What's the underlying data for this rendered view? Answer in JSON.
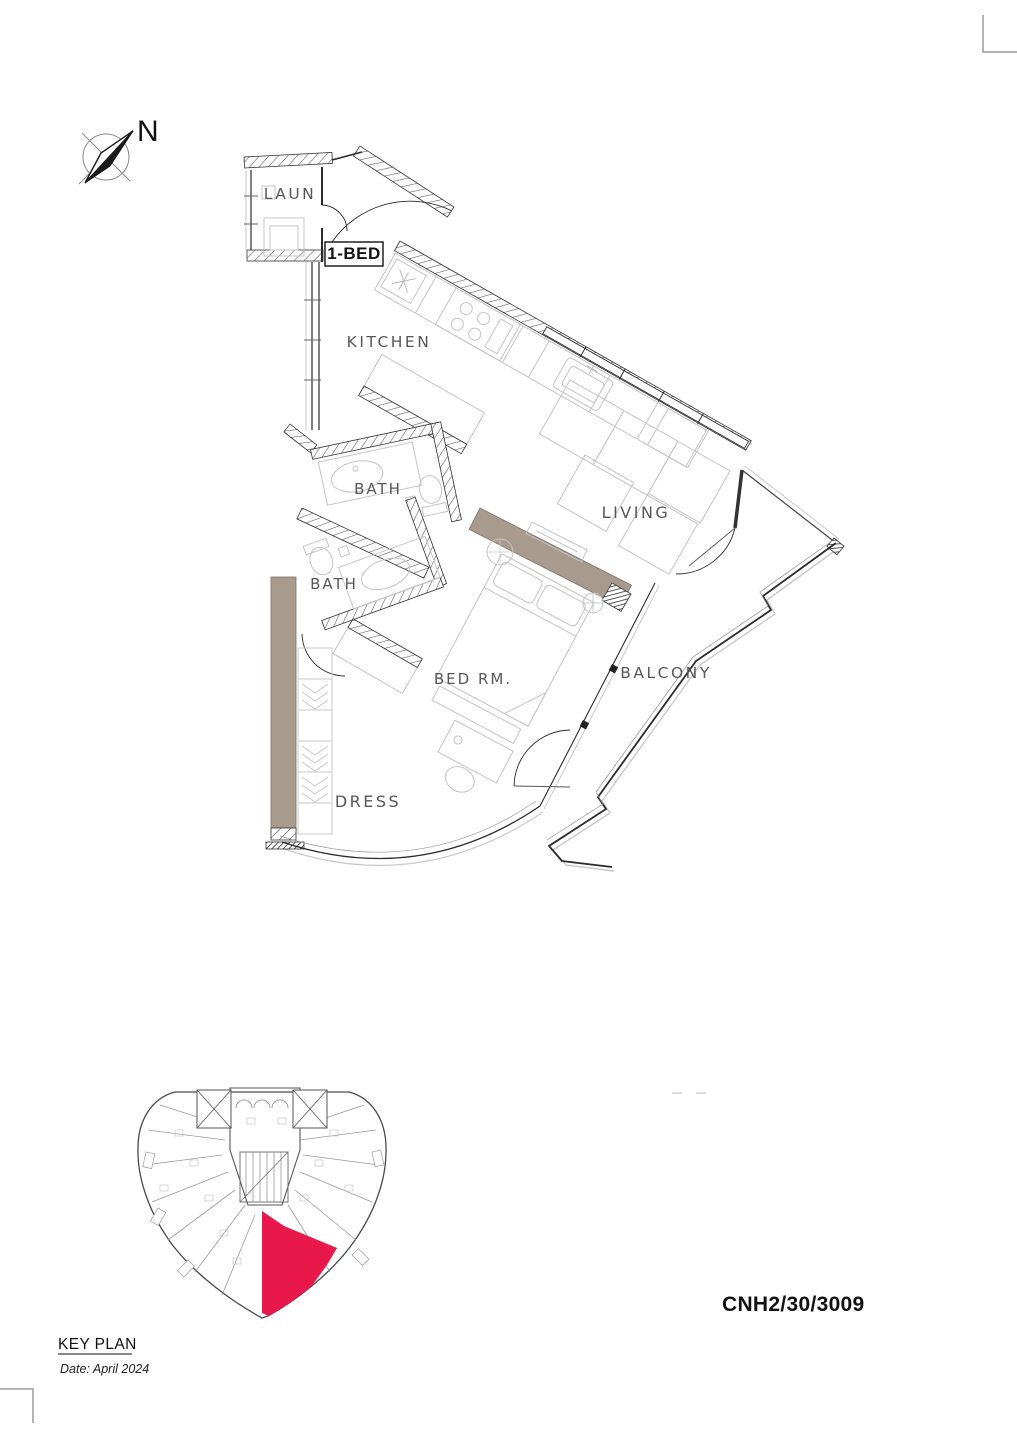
{
  "meta": {
    "unit_code": "CNH2/30/3009",
    "key_plan_label": "KEY PLAN",
    "date_label": "Date: April 2024",
    "north_label": "N",
    "unit_type_label": "1-BED"
  },
  "rooms": {
    "laundry": "LAUN",
    "kitchen": "KITCHEN",
    "bath_upper": "BATH",
    "bath_lower": "BATH",
    "living": "LIVING",
    "bedroom": "BED RM.",
    "dress": "DRESS",
    "balcony": "BALCONY"
  },
  "colors": {
    "highlight_red": "#E8194A",
    "wall_taupe": "#A89B8E",
    "line_dark": "#2b2b2b",
    "furniture_gray": "#c4c4c4",
    "label_gray": "#575757",
    "crop_mark_gray": "#9a9a9a"
  }
}
